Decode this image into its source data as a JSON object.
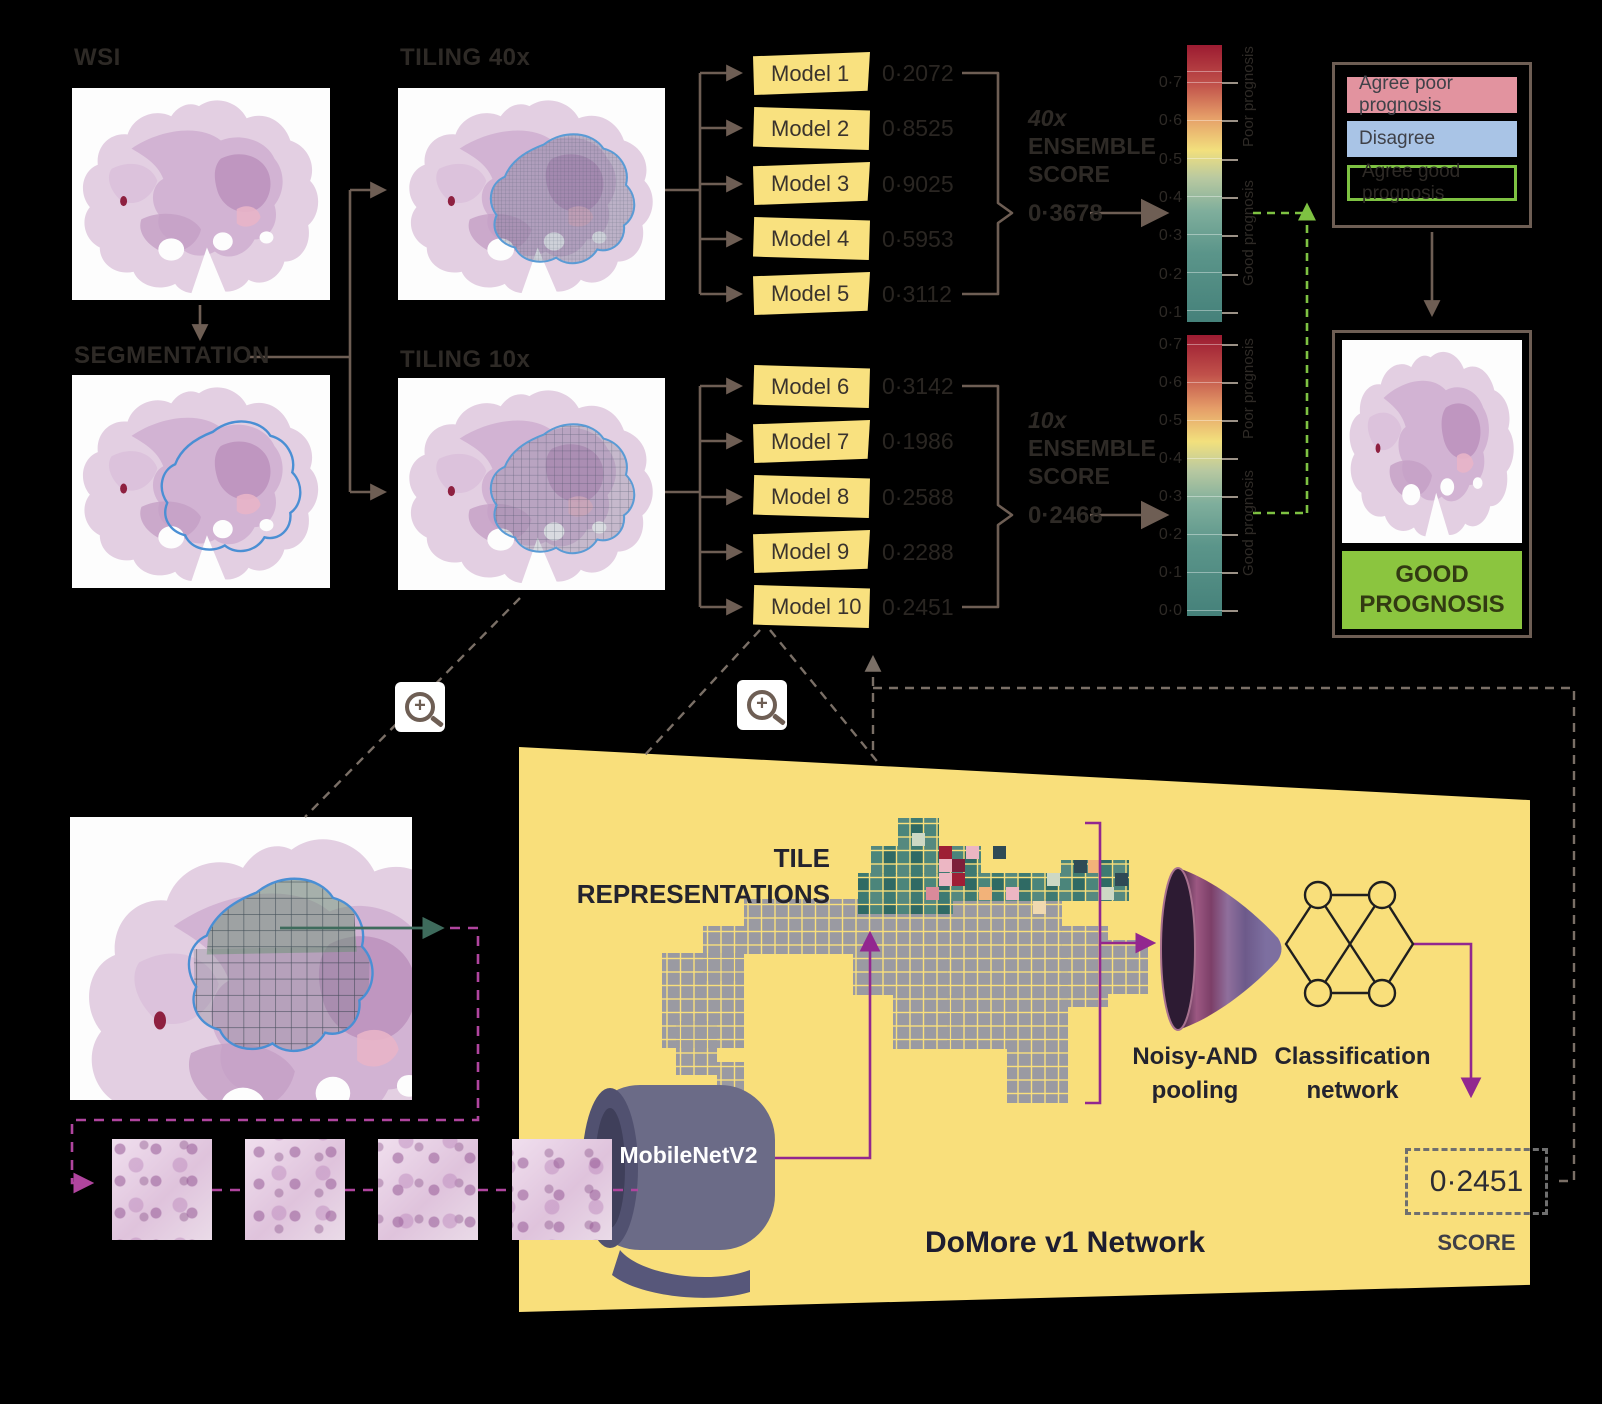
{
  "stages": {
    "wsi": "WSI",
    "segmentation": "SEGMENTATION",
    "tiling40": "TILING 40x",
    "tiling10": "TILING 10x"
  },
  "models_40x": [
    {
      "label": "Model 1",
      "score": "0·2072"
    },
    {
      "label": "Model 2",
      "score": "0·8525"
    },
    {
      "label": "Model 3",
      "score": "0·9025"
    },
    {
      "label": "Model 4",
      "score": "0·5953"
    },
    {
      "label": "Model 5",
      "score": "0·3112"
    }
  ],
  "models_10x": [
    {
      "label": "Model 6",
      "score": "0·3142"
    },
    {
      "label": "Model 7",
      "score": "0·1986"
    },
    {
      "label": "Model 8",
      "score": "0·2588"
    },
    {
      "label": "Model 9",
      "score": "0·2288"
    },
    {
      "label": "Model 10",
      "score": "0·2451"
    }
  ],
  "ensemble_40x": {
    "magnification": "40x",
    "word1": "ENSEMBLE",
    "word2": "SCORE",
    "value": "0·3678"
  },
  "ensemble_10x": {
    "magnification": "10x",
    "word1": "ENSEMBLE",
    "word2": "SCORE",
    "value": "0·2468"
  },
  "colorbars": {
    "bar1_ticks": [
      "0·7",
      "0·6",
      "0·5",
      "0·4",
      "0·3",
      "0·2",
      "0·1"
    ],
    "bar2_ticks": [
      "0·7",
      "0·6",
      "0·5",
      "0·4",
      "0·3",
      "0·2",
      "0·1",
      "0·0"
    ],
    "poor_label": "Poor prognosis",
    "good_label": "Good prognosis",
    "gradient": [
      "#9c1b31",
      "#c0504a",
      "#e59d68",
      "#f2e07d",
      "#b9c9a0",
      "#7fae9c",
      "#45817a"
    ]
  },
  "legend": {
    "items": [
      {
        "label": "Agree poor prognosis"
      },
      {
        "label": "Disagree"
      },
      {
        "label": "Agree good prognosis"
      }
    ]
  },
  "result": {
    "label": "GOOD PROGNOSIS"
  },
  "network_panel": {
    "tile_representations_line1": "TILE",
    "tile_representations_line2": "REPRESENTATIONS",
    "backbone": "MobileNetV2",
    "pooling_line1": "Noisy-AND",
    "pooling_line2": "pooling",
    "classifier_line1": "Classification",
    "classifier_line2": "network",
    "title": "DoMore v1 Network",
    "score_value": "0·2451",
    "score_label": "SCORE"
  },
  "colors": {
    "panel_yellow": "#f9df7b",
    "model_yellow": "#f9e17f",
    "arrow_brown": "#6e5e54",
    "purple": "#92278f",
    "green_accent": "#7ec242",
    "good_green": "#8bc53f",
    "legend_pink": "#e2939f",
    "legend_blue": "#a9c4e6"
  }
}
